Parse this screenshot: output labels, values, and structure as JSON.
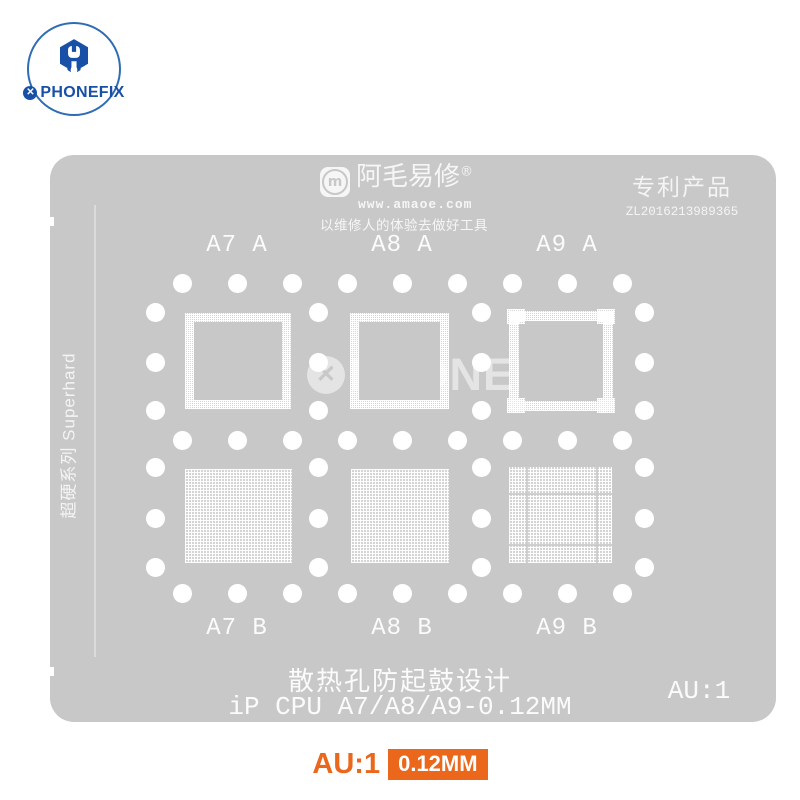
{
  "brand": {
    "logo_text": "PHONEFIX",
    "logo_icon": "hex-wrench-icon",
    "badge_glyph": "✕"
  },
  "stencil": {
    "maker": {
      "name": "阿毛易修",
      "registered_mark": "®",
      "logo_letter": "m",
      "website": "www.amaoe.com",
      "slogan": "以维修人的体验去做好工具"
    },
    "patent": {
      "title": "专利产品",
      "number": "ZL2016213989365"
    },
    "series_label": "超硬系列 Superhard",
    "watermark": {
      "badge_glyph": "✕",
      "text": "PHONEFIX"
    },
    "groups": [
      {
        "label": "A7 A",
        "pattern": "frame-mesh"
      },
      {
        "label": "A8 A",
        "pattern": "frame-mesh"
      },
      {
        "label": "A9 A",
        "pattern": "frame-mesh-corners"
      },
      {
        "label": "A7 B",
        "pattern": "full-mesh"
      },
      {
        "label": "A8 B",
        "pattern": "full-mesh"
      },
      {
        "label": "A9 B",
        "pattern": "full-mesh-divided"
      }
    ],
    "footer": {
      "design_text": "散热孔防起鼓设计",
      "model_text": "iP CPU A7/A8/A9-0.12MM",
      "gold_ratio": "AU:1"
    }
  },
  "caption": {
    "gold_ratio": "AU:1",
    "thickness": "0.12MM"
  },
  "colors": {
    "brand_blue": "#1750A6",
    "accent_orange": "#EA671C",
    "stencil_gray": "#C8C8C9"
  }
}
